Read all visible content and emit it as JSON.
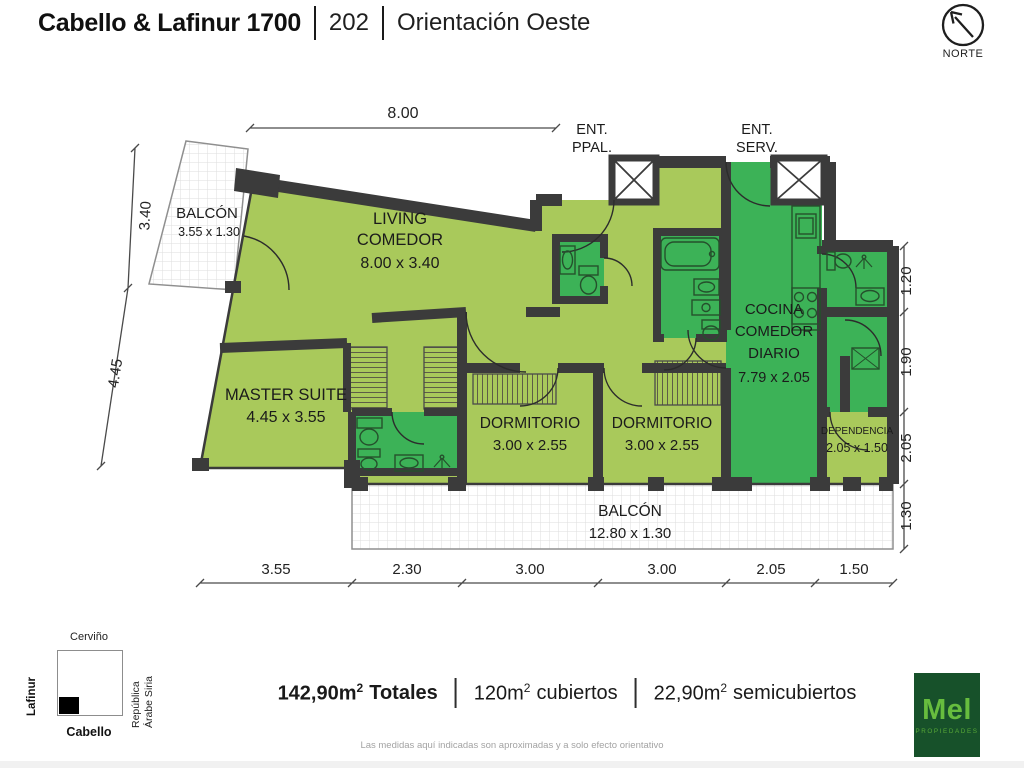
{
  "header": {
    "building": "Cabello & Lafinur 1700",
    "unit": "202",
    "orientation": "Orientación Oeste"
  },
  "north_label": "NORTE",
  "plan": {
    "rooms": [
      {
        "lines": [
          "BALCÓN"
        ],
        "dims": "3.55 x 1.30"
      },
      {
        "lines": [
          "LIVING",
          "COMEDOR"
        ],
        "dims": "8.00 x 3.40"
      },
      {
        "lines": [
          "MASTER SUITE"
        ],
        "dims": "4.45 x 3.55"
      },
      {
        "lines": [
          "DORMITORIO"
        ],
        "dims": "3.00 x 2.55"
      },
      {
        "lines": [
          "DORMITORIO"
        ],
        "dims": "3.00 x 2.55"
      },
      {
        "lines": [
          "COCINA",
          "COMEDOR",
          "DIARIO"
        ],
        "dims": "7.79 x 2.05"
      },
      {
        "lines": [
          "DEPENDENCIA"
        ],
        "dims": "2.05 x 1.50"
      },
      {
        "lines": [
          "BALCÓN"
        ],
        "dims": "12.80 x 1.30"
      }
    ],
    "entrance_main": [
      "ENT.",
      "PPAL."
    ],
    "entrance_service": [
      "ENT.",
      "SERV."
    ],
    "dims": {
      "top": "8.00",
      "left": [
        "3.40",
        "4.45"
      ],
      "right": [
        "1.20",
        "1.90",
        "2.05",
        "1.30"
      ],
      "bottom": [
        "3.55",
        "2.30",
        "3.00",
        "3.00",
        "2.05",
        "1.50"
      ]
    }
  },
  "map": {
    "top": "Cerviño",
    "left": "Lafinur",
    "right_lines": [
      "República",
      "Árabe Siria"
    ],
    "bottom": "Cabello"
  },
  "areas": {
    "total": {
      "value": "142,90m",
      "sup": "2",
      "label": "Totales"
    },
    "covered": {
      "value": "120m",
      "sup": "2",
      "label": "cubiertos"
    },
    "semicovered": {
      "value": "22,90m",
      "sup": "2",
      "label": "semicubiertos"
    }
  },
  "logo": {
    "name": "Mel",
    "sub": "PROPIEDADES"
  },
  "disclaimer": "Las medidas aquí indicadas son aproximadas y a solo efecto orientativo",
  "colors": {
    "light_green": "#a9c95b",
    "dark_green": "#3cb257",
    "wall": "#3b3b3b",
    "logo_bg": "#17512a",
    "logo_green": "#67bd3e"
  }
}
